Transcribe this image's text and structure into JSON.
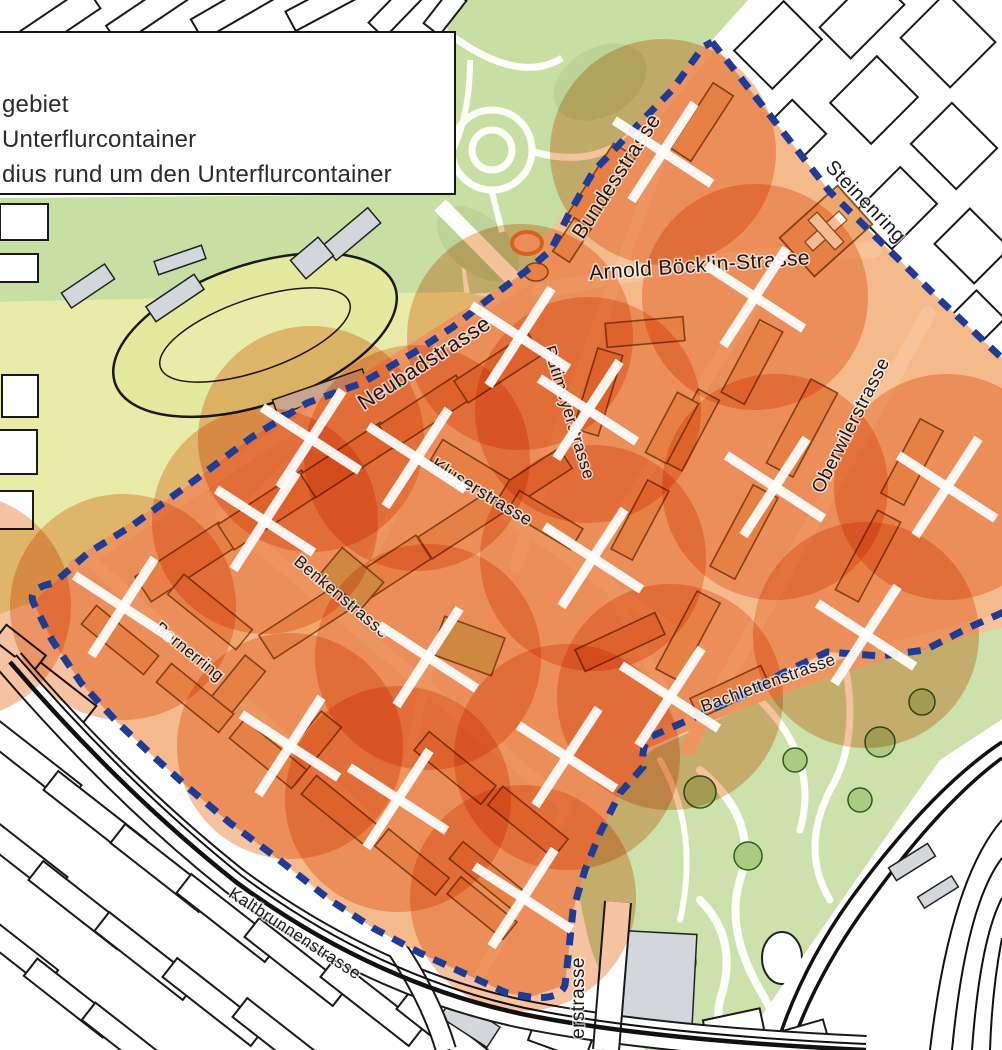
{
  "legend": {
    "items": [
      {
        "label": "gebiet"
      },
      {
        "label": "Unterflurcontainer"
      },
      {
        "label": "dius rund um den Unterflurcontainer"
      }
    ]
  },
  "map": {
    "colors": {
      "outside_fill": "#ffffff",
      "outside_stroke": "#1a1a1a",
      "gray_fill": "#d3d7dc",
      "green_strip": "#c8dfa3",
      "field_green": "#e9eca9",
      "oval_green": "#e3e99e",
      "park_green": "#c8dfa3",
      "park_patch": "#b9d496",
      "zoo_green": "#cce1ab",
      "tree_green": "#aacb81",
      "tree_stroke": "#2f5b1f",
      "path_white": "#fdfff8",
      "pilot_base": "#f5ba8c",
      "building_fill": "#f0a76b",
      "building_stroke": "#8a5220",
      "school_tan": "#d9b266",
      "street_light": "#f7c398",
      "circle_orange": "#e56a14",
      "boundary_blue": "#1e3c96",
      "marker_white": "#ffffff",
      "label_ink": "#1a1a1a",
      "rail_black": "#111111",
      "plaza_ring": "#df8030"
    },
    "pilot_fill_path": "M 712,42 L 740,77 830,192 940,300 1004,360 L 1004,612 970,627 925,650 880,656 827,652 783,673 740,697 693,718 650,737 643,767 620,793 600,833 585,870 573,910 568,958 565,985 530,997 507,993 485,983 420,953 373,928 330,900 273,855 230,823 191,790 154,757 117,722 81,683 52,640 33,602 54,583 88,553 133,525 195,480 252,437 307,403 362,383 415,352 453,327 490,298 530,268 551,250 569,214 593,172 630,133 672,90 703,47 Z",
    "boundary_paths": [
      "M 712,42 L 740,77 830,192 940,300 1004,360",
      "M 1004,612 L 970,627 925,650 880,656 827,652 783,673 740,697 693,718 650,737 Q 641,746 643,767 L 620,793 600,833 585,870 573,910 568,958 565,985 Q 560,1000 530,997 L 507,993 485,983 420,953 373,928 330,900 273,855 230,823 191,790 154,757 117,722 81,683 52,640 33,602 Q 28,588 54,583 L 88,553 133,525 195,480 252,437 307,403 362,383 415,352 453,327 490,298 530,268 551,250 569,214 593,172 630,133 672,90 703,47 712,42"
    ],
    "boundary_style": {
      "width": 7,
      "dash": "13 10"
    },
    "green_strip_path": "M 0,198 L 455,194 464,292 0,302 Z",
    "field_path": "M 0,302 L 464,292 492,298 453,327 362,383 252,437 133,525 54,583 33,602 0,614 Z",
    "oval": {
      "cx": 255,
      "cy": 335,
      "rx": 148,
      "ry": 70,
      "rot": -19,
      "inner_rx": 100,
      "inner_ry": 36
    },
    "park_path": "M 448,0 L 748,0 705,48 560,250 530,290 470,294 446,160 Z",
    "park_paths_white": [
      [
        "M 455,38 Q 520,84 562,58",
        7
      ],
      [
        "M 492,192 L 502,232",
        6
      ],
      [
        "M 534,152 Q 605,172 648,118",
        7
      ],
      [
        "M 448,160 Q 470,120 470,60",
        6
      ],
      [
        "M 440,205 L 524,290",
        16
      ]
    ],
    "park_rings": [
      [
        492,
        150,
        40
      ],
      [
        492,
        150,
        20
      ]
    ],
    "park_patches": [
      [
        600,
        82,
        50,
        34,
        -30
      ],
      [
        478,
        244,
        48,
        28,
        40
      ]
    ],
    "green_wedge_path": "M 795,288 Q 905,335 1004,436 L 1004,476 Q 898,382 788,312 Z",
    "zoo_path": "M 655,748 L 845,662 1004,622 1004,1050 645,1050 Q 598,975 590,945 Q 578,898 576,868 Q 590,795 655,748 Z",
    "zoo_paths_white": [
      [
        "M 700,770 Q 760,820 740,880 Q 725,930 760,990 Q 790,1040 770,1050",
        8
      ],
      [
        "M 845,665 Q 860,740 830,790 Q 800,850 830,900",
        7
      ],
      [
        "M 760,700 Q 820,760 800,830",
        7
      ],
      [
        "M 700,900 Q 740,940 720,1000 Q 713,1030 735,1050",
        8
      ],
      [
        "M 660,760 Q 700,830 680,920",
        6
      ]
    ],
    "zoo_trees": [
      [
        700,
        792,
        16
      ],
      [
        748,
        856,
        14
      ],
      [
        880,
        742,
        15
      ],
      [
        922,
        702,
        13
      ],
      [
        682,
        962,
        14
      ],
      [
        795,
        760,
        12
      ],
      [
        860,
        800,
        12
      ]
    ],
    "zoo_pond": {
      "cx": 782,
      "cy": 958,
      "rx": 20,
      "ry": 26
    },
    "rail_band_path": "M 1004,718 L 940,760 Q 868,862 738,1050 L 1004,1050 Z",
    "rails": [
      [
        "M 1002,742 Q 930,790 850,900 Q 800,970 775,1050",
        3.5
      ],
      [
        "M 1002,758 Q 938,805 862,912 Q 814,980 790,1050",
        3.5
      ],
      [
        "M 1002,820 Q 950,880 930,1050",
        2
      ],
      [
        "M 1002,858 Q 966,905 952,1050",
        2
      ],
      [
        "M 1002,898 Q 980,940 972,1050",
        2
      ],
      [
        "M 1002,938 Q 992,990 990,1050",
        2
      ]
    ],
    "outside_blocks": [
      [
        60,
        20,
        80,
        26,
        -34
      ],
      [
        148,
        12,
        85,
        24,
        -34
      ],
      [
        238,
        6,
        95,
        24,
        -30
      ],
      [
        325,
        3,
        78,
        22,
        -28
      ],
      [
        398,
        8,
        62,
        22,
        -46
      ],
      [
        445,
        12,
        44,
        20,
        -52
      ],
      [
        778,
        45,
        70,
        54,
        -45
      ],
      [
        862,
        16,
        76,
        44,
        -45
      ],
      [
        948,
        40,
        64,
        70,
        -45
      ],
      [
        788,
        138,
        60,
        48,
        -45
      ],
      [
        874,
        100,
        66,
        58,
        -45
      ],
      [
        954,
        146,
        58,
        64,
        -45
      ],
      [
        812,
        226,
        56,
        46,
        -45
      ],
      [
        896,
        208,
        64,
        52,
        -45
      ],
      [
        972,
        246,
        50,
        56,
        -45
      ],
      [
        862,
        300,
        56,
        40,
        -45
      ],
      [
        975,
        320,
        44,
        40,
        -45
      ],
      [
        24,
        222,
        48,
        36,
        0
      ],
      [
        18,
        268,
        40,
        28,
        0
      ],
      [
        20,
        396,
        36,
        42,
        0
      ],
      [
        18,
        452,
        38,
        44,
        0
      ],
      [
        16,
        510,
        34,
        38,
        0
      ],
      [
        30,
        760,
        112,
        24,
        38
      ],
      [
        95,
        815,
        112,
        24,
        38
      ],
      [
        162,
        868,
        112,
        24,
        38
      ],
      [
        228,
        918,
        112,
        24,
        38
      ],
      [
        296,
        962,
        112,
        24,
        38
      ],
      [
        372,
        1002,
        112,
        24,
        38
      ],
      [
        448,
        1034,
        112,
        24,
        38
      ],
      [
        16,
        852,
        112,
        24,
        38
      ],
      [
        80,
        905,
        112,
        24,
        38
      ],
      [
        146,
        956,
        112,
        24,
        38
      ],
      [
        214,
        1002,
        112,
        24,
        38
      ],
      [
        284,
        1042,
        112,
        24,
        38
      ],
      [
        12,
        948,
        100,
        22,
        38
      ],
      [
        70,
        998,
        100,
        22,
        38
      ],
      [
        128,
        1042,
        100,
        22,
        38
      ],
      [
        58,
        690,
        80,
        22,
        38
      ],
      [
        20,
        648,
        50,
        20,
        38
      ],
      [
        560,
        1040,
        60,
        22,
        20
      ],
      [
        735,
        1032,
        58,
        36,
        -12
      ],
      [
        795,
        1042,
        66,
        28,
        -16
      ]
    ],
    "gray_blocks": [
      [
        895,
        345,
        60,
        26,
        -45
      ],
      [
        952,
        368,
        54,
        24,
        -45
      ],
      [
        648,
        988,
        92,
        112,
        3
      ],
      [
        88,
        286,
        52,
        18,
        -34
      ],
      [
        175,
        298,
        58,
        18,
        -34
      ],
      [
        352,
        234,
        58,
        20,
        -40
      ],
      [
        312,
        258,
        36,
        24,
        -40
      ],
      [
        470,
        1022,
        56,
        24,
        33
      ],
      [
        912,
        862,
        46,
        15,
        -32
      ],
      [
        938,
        892,
        40,
        13,
        -32
      ],
      [
        320,
        392,
        95,
        16,
        -19
      ],
      [
        180,
        260,
        50,
        14,
        -19
      ]
    ],
    "roads_outside": [
      {
        "d": "M 10,662 Q 120,790 236,882 Q 372,982 522,1014 Q 650,1040 866,1050",
        "w": 26
      },
      {
        "d": "M 398,950 Q 432,1002 446,1050",
        "w": 18
      },
      {
        "d": "M 618,902 L 606,1050",
        "w": 24
      }
    ],
    "tram_lines": [
      {
        "d": "M 10,662 Q 120,790 236,882 Q 372,982 522,1014 Q 650,1040 866,1050",
        "w": 4.5
      },
      {
        "d": "M 16,655 Q 126,783 242,876 Q 377,976 525,1008 Q 652,1034 866,1044",
        "w": 2
      }
    ],
    "streets_inside": [
      [
        "M 540,252 L 706,52",
        12
      ],
      [
        "M 75,566 L 455,323 522,282",
        13
      ],
      [
        "M 540,292 Q 700,256 874,250",
        16
      ],
      [
        "M 614,284 L 560,430 516,566",
        13
      ],
      [
        "M 664,150 L 614,284",
        11
      ],
      [
        "M 378,424 L 700,650",
        13
      ],
      [
        "M 222,514 L 566,806",
        13
      ],
      [
        "M 88,558 L 445,890",
        13
      ],
      [
        "M 928,314 L 688,748",
        15
      ],
      [
        "M 640,744 Q 820,664 1004,620",
        14
      ],
      [
        "M 758,298 L 594,556 668,700",
        12
      ],
      [
        "M 314,440 L 232,522",
        10
      ],
      [
        "M 420,460 L 352,596",
        10
      ],
      [
        "M 430,660 L 400,800",
        10
      ],
      [
        "M 568,806 L 523,900 480,975",
        11
      ]
    ],
    "inside_buildings": [
      [
        185,
        562,
        100,
        30,
        -33
      ],
      [
        268,
        510,
        100,
        30,
        -33
      ],
      [
        348,
        460,
        95,
        28,
        -33
      ],
      [
        425,
        412,
        92,
        28,
        -33
      ],
      [
        498,
        368,
        88,
        26,
        -33
      ],
      [
        305,
        622,
        92,
        28,
        -33
      ],
      [
        385,
        572,
        92,
        28,
        -33
      ],
      [
        462,
        524,
        88,
        26,
        -33
      ],
      [
        532,
        480,
        80,
        24,
        -33
      ],
      [
        210,
        612,
        88,
        26,
        39
      ],
      [
        232,
        692,
        26,
        74,
        39
      ],
      [
        308,
        748,
        26,
        74,
        39
      ],
      [
        120,
        640,
        80,
        24,
        39
      ],
      [
        195,
        698,
        80,
        24,
        39
      ],
      [
        268,
        754,
        80,
        24,
        39
      ],
      [
        340,
        810,
        80,
        24,
        39
      ],
      [
        412,
        862,
        78,
        22,
        39
      ],
      [
        482,
        908,
        72,
        22,
        39
      ],
      [
        455,
        768,
        86,
        24,
        39
      ],
      [
        528,
        822,
        84,
        24,
        39
      ],
      [
        488,
        876,
        82,
        22,
        39
      ],
      [
        802,
        428,
        95,
        30,
        -62
      ],
      [
        744,
        532,
        92,
        28,
        -62
      ],
      [
        688,
        636,
        88,
        26,
        -62
      ],
      [
        868,
        556,
        90,
        26,
        -62
      ],
      [
        912,
        462,
        84,
        26,
        -62
      ],
      [
        752,
        362,
        82,
        26,
        -62
      ],
      [
        690,
        430,
        80,
        24,
        -62
      ],
      [
        640,
        520,
        78,
        24,
        -62
      ],
      [
        620,
        642,
        88,
        24,
        -25
      ],
      [
        730,
        692,
        78,
        22,
        -25
      ],
      [
        600,
        188,
        90,
        26,
        -57
      ],
      [
        702,
        122,
        78,
        24,
        -57
      ],
      [
        572,
        240,
        40,
        20,
        -57
      ],
      [
        645,
        332,
        78,
        24,
        -5
      ],
      [
        598,
        392,
        26,
        84,
        17
      ],
      [
        672,
        428,
        68,
        24,
        -62
      ],
      [
        470,
        470,
        78,
        24,
        31
      ],
      [
        545,
        520,
        74,
        24,
        31
      ],
      [
        468,
        646,
        64,
        40,
        20,
        "#d9b266"
      ],
      [
        352,
        578,
        54,
        34,
        40,
        "#d9b266"
      ]
    ],
    "church": {
      "cx": 826,
      "cy": 231,
      "w": 78,
      "h": 52,
      "rot": -42
    },
    "plaza": {
      "ring": [
        527,
        243,
        15,
        11
      ],
      "blob": [
        536,
        272,
        12,
        9
      ]
    },
    "circle_radius": 113,
    "circle_opacity": 0.4,
    "extra_circle_centers": [
      [
        -42,
        606
      ]
    ],
    "markers": [
      [
        663,
        152
      ],
      [
        755,
        297
      ],
      [
        520,
        337
      ],
      [
        588,
        410
      ],
      [
        311,
        439
      ],
      [
        417,
        458
      ],
      [
        265,
        521
      ],
      [
        123,
        607
      ],
      [
        775,
        487
      ],
      [
        947,
        487
      ],
      [
        593,
        558
      ],
      [
        428,
        657
      ],
      [
        670,
        697
      ],
      [
        866,
        635
      ],
      [
        290,
        746
      ],
      [
        398,
        799
      ],
      [
        567,
        757
      ],
      [
        523,
        898
      ]
    ],
    "marker_style": {
      "half": 41,
      "width": 9.5,
      "rot": -12
    },
    "street_labels": [
      {
        "text": "Bundesstrasse",
        "x": 622,
        "y": 180,
        "rot": -57,
        "size": 21
      },
      {
        "text": "Steinenring",
        "x": 861,
        "y": 206,
        "rot": 46,
        "size": 20
      },
      {
        "text": "Arnold Böcklin-Strasse",
        "x": 700,
        "y": 272,
        "rot": -4,
        "size": 21
      },
      {
        "text": "Neubadstrasse",
        "x": 428,
        "y": 369,
        "rot": -33,
        "size": 22
      },
      {
        "text": "Rütimeyerstrasse",
        "x": 564,
        "y": 414,
        "rot": 73,
        "size": 17
      },
      {
        "text": "Oberwilerstrasse",
        "x": 856,
        "y": 428,
        "rot": -63,
        "size": 19
      },
      {
        "text": "Kluserstrasse",
        "x": 479,
        "y": 497,
        "rot": 31,
        "size": 18
      },
      {
        "text": "Benkenstrasse",
        "x": 338,
        "y": 601,
        "rot": 40,
        "size": 17
      },
      {
        "text": "Bernerring",
        "x": 186,
        "y": 656,
        "rot": 39,
        "size": 17
      },
      {
        "text": "Bachlettenstrasse",
        "x": 770,
        "y": 688,
        "rot": -20,
        "size": 17
      },
      {
        "text": "Kaltbrunnenstrasse",
        "x": 292,
        "y": 938,
        "rot": 33,
        "size": 17
      },
      {
        "text": "erstrasse",
        "x": 584,
        "y": 998,
        "rot": -90,
        "size": 19
      }
    ]
  }
}
